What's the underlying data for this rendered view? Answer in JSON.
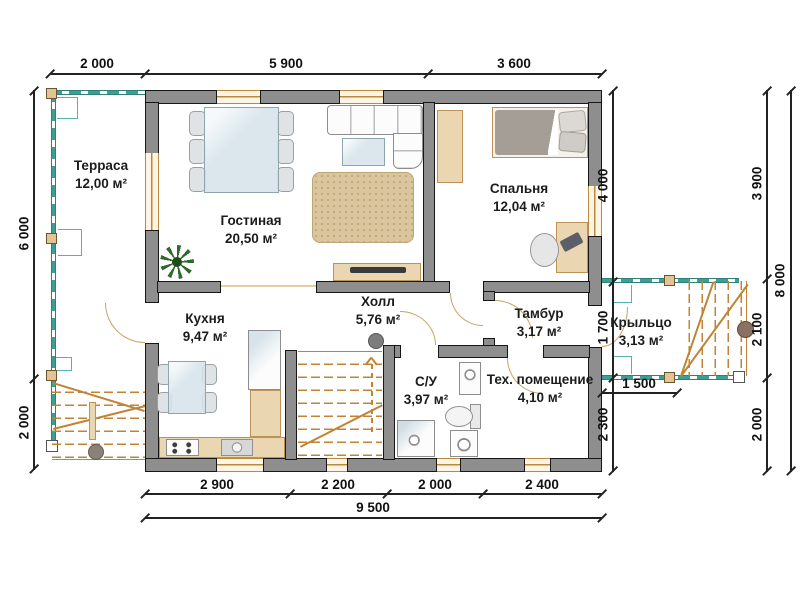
{
  "rooms": [
    {
      "name": "Терраса",
      "area": "12,00 м²"
    },
    {
      "name": "Гостиная",
      "area": "20,50 м²"
    },
    {
      "name": "Спальня",
      "area": "12,04 м²"
    },
    {
      "name": "Кухня",
      "area": "9,47 м²"
    },
    {
      "name": "Холл",
      "area": "5,76 м²"
    },
    {
      "name": "Тамбур",
      "area": "3,17 м²"
    },
    {
      "name": "С/У",
      "area": "3,97 м²"
    },
    {
      "name": "Тех. помещение",
      "area": "4,10 м²"
    },
    {
      "name": "Крыльцо",
      "area": "3,13 м²"
    }
  ],
  "dimensions": {
    "top": [
      "2 000",
      "5 900",
      "3 600"
    ],
    "bottom": [
      "2 900",
      "2 200",
      "2 000",
      "2 400"
    ],
    "bottom_total": "9 500",
    "left": [
      "6 000",
      "2 000"
    ],
    "right_inner": [
      "4 000",
      "1 700",
      "2 300"
    ],
    "right_outer": [
      "3 900",
      "2 100",
      "2 000"
    ],
    "right_total": "8 000",
    "porch_width": "1 500"
  },
  "colors": {
    "wall": "#8e8e8e",
    "wall_outline": "#161616",
    "window_frame": "#b9893f",
    "railing": "#3d9e95",
    "stairs": "#c08434",
    "furniture_wood": "#ead7b2",
    "carpet": "#d9c69e",
    "text": "#111111"
  }
}
